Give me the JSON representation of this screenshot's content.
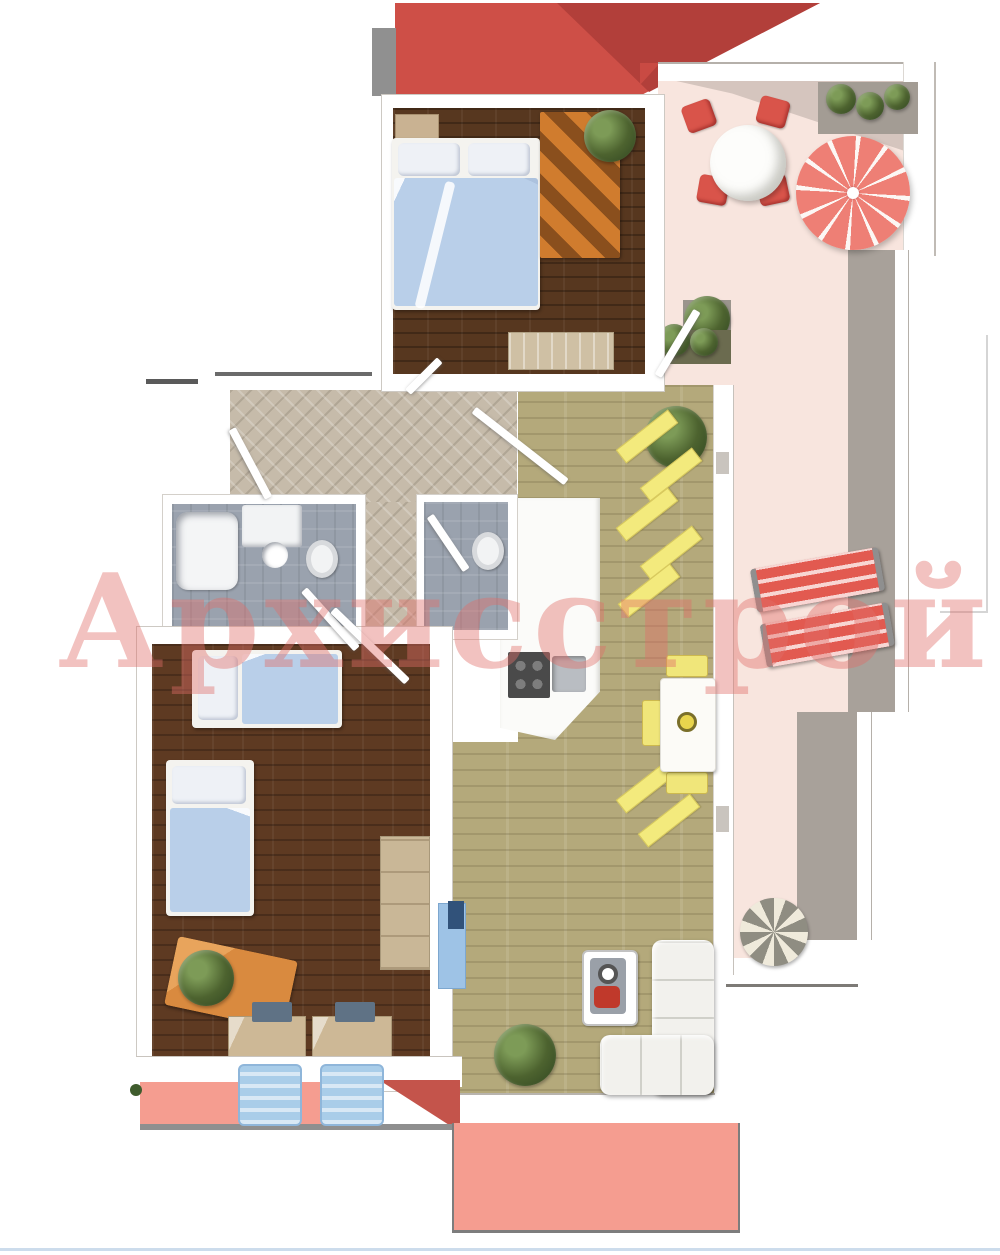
{
  "watermark": {
    "text": "Архисстрой",
    "color": "#e06e6a",
    "opacity": 0.42
  },
  "palette": {
    "roof_red": "#ce4f47",
    "roof_red_dark": "#b23f3a",
    "terrace_pink": "#f8e5de",
    "balcony_salmon": "#f59d90",
    "balcony_roof_dark": "#c4544b",
    "wood_floor": "#b4a97b",
    "bedroom_floor": "#57371f",
    "children_floor": "#5e3a22",
    "hall_tile": "#c6bbaa",
    "bath_gray": "#9aa2ae",
    "wall_gray": "#a8a19a",
    "blanket_blue": "#b9cfe9",
    "furniture_yellow": "#f3ea7d",
    "umbrella_red": "#ee7f75",
    "chair_red": "#d9544a",
    "wardrobe_orange": "#d07c2e"
  },
  "scene": {
    "type": "3d-floor-plan-render",
    "rooms": [
      "master-bedroom",
      "terrace",
      "hallway",
      "bathroom",
      "wc",
      "kitchen-living-room",
      "children-room",
      "balcony-left",
      "balcony-right"
    ],
    "furniture": [
      "double-bed",
      "wardrobe",
      "round-table",
      "parasol-umbrella",
      "sun-loungers",
      "bathtub",
      "toilet",
      "kitchen-counter",
      "cooktop",
      "dining-table",
      "corner-sofa",
      "children-beds",
      "desks",
      "plants"
    ]
  }
}
